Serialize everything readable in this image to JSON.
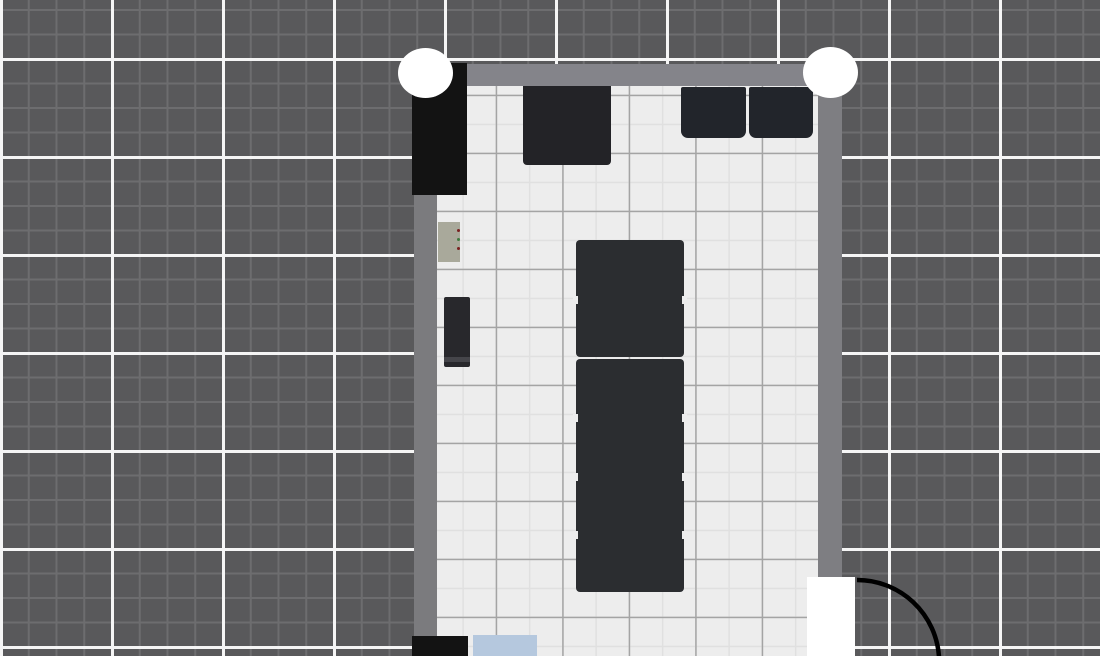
{
  "app": {
    "name": "floor-plan-editor-canvas",
    "canvas": {
      "width": 1100,
      "height": 656
    }
  },
  "colors": {
    "background": "#59595b",
    "background_minor_line": "#6d6d6f",
    "background_major_line": "#f5f5f5",
    "floor": "#ededed",
    "floor_minor_line": "#e0e0e0",
    "floor_major_line": "#a4a4a4",
    "wall": "#7f7f82",
    "furniture_dark": "#2b2d30",
    "furniture_black": "#131313",
    "seat_dark": "#22252b",
    "panel_beige": "#a9a99b",
    "item_blue": "#b5c8de",
    "marker_white": "#ffffff",
    "door_leaf": "#ffffff",
    "door_arc": "#000000"
  },
  "background_grid": {
    "base": "#59595b",
    "major_color": "#f5f5f5",
    "major_px": 3,
    "major_size_x": 111,
    "major_size_y": 98,
    "major_offset_x": 0,
    "major_offset_y": 58,
    "minor_color": "#6d6d6f",
    "minor_px": 2,
    "minor_size_x": 27.75,
    "minor_size_y": 24.5,
    "minor_offset_x": 0,
    "minor_offset_y": 9
  },
  "floor_grid": {
    "base": "#ededed",
    "major_color": "#a4a4a4",
    "major_px": 1.5,
    "major_size_x": 66.5,
    "major_size_y": 58,
    "major_offset_x": 58.7,
    "major_offset_y": 66.7,
    "minor_color": "#e0e0e0",
    "minor_px": 1.5,
    "minor_size_x": 33.25,
    "minor_size_y": 29,
    "minor_offset_x": 25.4,
    "minor_offset_y": 37.7
  },
  "scene": {
    "elements": [
      {
        "name": "room-floor",
        "interactable": true,
        "shape": "rect",
        "x": 437,
        "y": 86,
        "w": 381,
        "h": 570,
        "color": "#ededed",
        "grid": "floor"
      },
      {
        "name": "wall-top",
        "interactable": true,
        "shape": "rect",
        "x": 414,
        "y": 64,
        "w": 428,
        "h": 22,
        "color": "#84848a"
      },
      {
        "name": "wall-left",
        "interactable": true,
        "shape": "rect",
        "x": 414,
        "y": 64,
        "w": 23,
        "h": 573,
        "color": "#7b7b7e"
      },
      {
        "name": "wall-right",
        "interactable": true,
        "shape": "rect",
        "x": 818,
        "y": 64,
        "w": 24,
        "h": 513,
        "color": "#7e7e82"
      },
      {
        "name": "wardrobe-black",
        "interactable": true,
        "shape": "rect",
        "x": 412,
        "y": 63,
        "w": 55,
        "h": 132,
        "color": "#131313"
      },
      {
        "name": "table-top-wall",
        "interactable": true,
        "shape": "rect",
        "x": 523,
        "y": 86,
        "w": 88,
        "h": 79,
        "color": "#232327",
        "radius": "0 0 4px 4px"
      },
      {
        "name": "seat-right-1",
        "interactable": true,
        "shape": "rect",
        "x": 681,
        "y": 87,
        "w": 65,
        "h": 51,
        "color": "#22252b",
        "radius": "2px 2px 7px 7px"
      },
      {
        "name": "seat-right-2",
        "interactable": true,
        "shape": "rect",
        "x": 749,
        "y": 87,
        "w": 64,
        "h": 51,
        "color": "#22252b",
        "radius": "2px 2px 7px 7px"
      },
      {
        "name": "radiator-panel",
        "interactable": true,
        "shape": "rect",
        "x": 438,
        "y": 222,
        "w": 22,
        "h": 40,
        "color": "#a9a99b",
        "children": [
          {
            "name": "panel-led-red-1",
            "interactable": false,
            "shape": "rect",
            "x": 19,
            "y": 7,
            "w": 3,
            "h": 3,
            "color": "#7a2020",
            "radius": "50%"
          },
          {
            "name": "panel-led-green",
            "interactable": false,
            "shape": "rect",
            "x": 19,
            "y": 16,
            "w": 3,
            "h": 3,
            "color": "#3f7a3f",
            "radius": "50%"
          },
          {
            "name": "panel-led-red-2",
            "interactable": false,
            "shape": "rect",
            "x": 19,
            "y": 25,
            "w": 3,
            "h": 3,
            "color": "#7a2020",
            "radius": "50%"
          }
        ]
      },
      {
        "name": "cabinet-small",
        "interactable": true,
        "shape": "rect",
        "x": 444,
        "y": 297,
        "w": 26,
        "h": 70,
        "color": "#28282c",
        "radius": "2px",
        "children": [
          {
            "name": "cabinet-base-strip",
            "interactable": false,
            "shape": "rect",
            "x": 0,
            "y": 60,
            "w": 26,
            "h": 5,
            "color": "#45454a"
          }
        ]
      },
      {
        "name": "table-block-upper",
        "interactable": true,
        "shape": "rect",
        "x": 576,
        "y": 240,
        "w": 108,
        "h": 117,
        "color": "#2b2d30",
        "radius": "4px"
      },
      {
        "name": "table-block-lower",
        "interactable": true,
        "shape": "rect",
        "x": 576,
        "y": 359,
        "w": 108,
        "h": 233,
        "color": "#2b2d30",
        "radius": "4px"
      },
      {
        "name": "table-gap-notch",
        "interactable": false,
        "shape": "rect",
        "x": 573,
        "y": 296,
        "w": 5,
        "h": 8,
        "color": "#ededed"
      },
      {
        "name": "table-gap-notch",
        "interactable": false,
        "shape": "rect",
        "x": 682,
        "y": 296,
        "w": 5,
        "h": 8,
        "color": "#ededed"
      },
      {
        "name": "table-gap-notch",
        "interactable": false,
        "shape": "rect",
        "x": 573,
        "y": 414,
        "w": 5,
        "h": 8,
        "color": "#ededed"
      },
      {
        "name": "table-gap-notch",
        "interactable": false,
        "shape": "rect",
        "x": 682,
        "y": 414,
        "w": 5,
        "h": 8,
        "color": "#ededed"
      },
      {
        "name": "table-gap-notch",
        "interactable": false,
        "shape": "rect",
        "x": 573,
        "y": 473,
        "w": 5,
        "h": 8,
        "color": "#ededed"
      },
      {
        "name": "table-gap-notch",
        "interactable": false,
        "shape": "rect",
        "x": 682,
        "y": 473,
        "w": 5,
        "h": 8,
        "color": "#ededed"
      },
      {
        "name": "table-gap-notch",
        "interactable": false,
        "shape": "rect",
        "x": 573,
        "y": 531,
        "w": 5,
        "h": 8,
        "color": "#ededed"
      },
      {
        "name": "table-gap-notch",
        "interactable": false,
        "shape": "rect",
        "x": 682,
        "y": 531,
        "w": 5,
        "h": 8,
        "color": "#ededed"
      },
      {
        "name": "cabinet-bottom-black",
        "interactable": true,
        "shape": "rect",
        "x": 412,
        "y": 636,
        "w": 56,
        "h": 20,
        "color": "#131313"
      },
      {
        "name": "table-bottom-blue",
        "interactable": true,
        "shape": "rect",
        "x": 473,
        "y": 635,
        "w": 64,
        "h": 21,
        "color": "#b5c8de"
      },
      {
        "name": "door-panel",
        "interactable": true,
        "shape": "rect",
        "x": 807,
        "y": 577,
        "w": 48,
        "h": 79,
        "color": "#ffffff"
      },
      {
        "name": "corner-marker-left",
        "interactable": true,
        "shape": "ellipse",
        "x": 398,
        "y": 48,
        "w": 55,
        "h": 50,
        "color": "#ffffff"
      },
      {
        "name": "corner-marker-right",
        "interactable": true,
        "shape": "ellipse",
        "x": 803,
        "y": 47,
        "w": 55,
        "h": 51,
        "color": "#ffffff"
      }
    ]
  },
  "door": {
    "arc_path": "M 857 580 A 82 82 0 0 1 939 657",
    "arc_color": "#000000",
    "arc_width": 4.5
  }
}
